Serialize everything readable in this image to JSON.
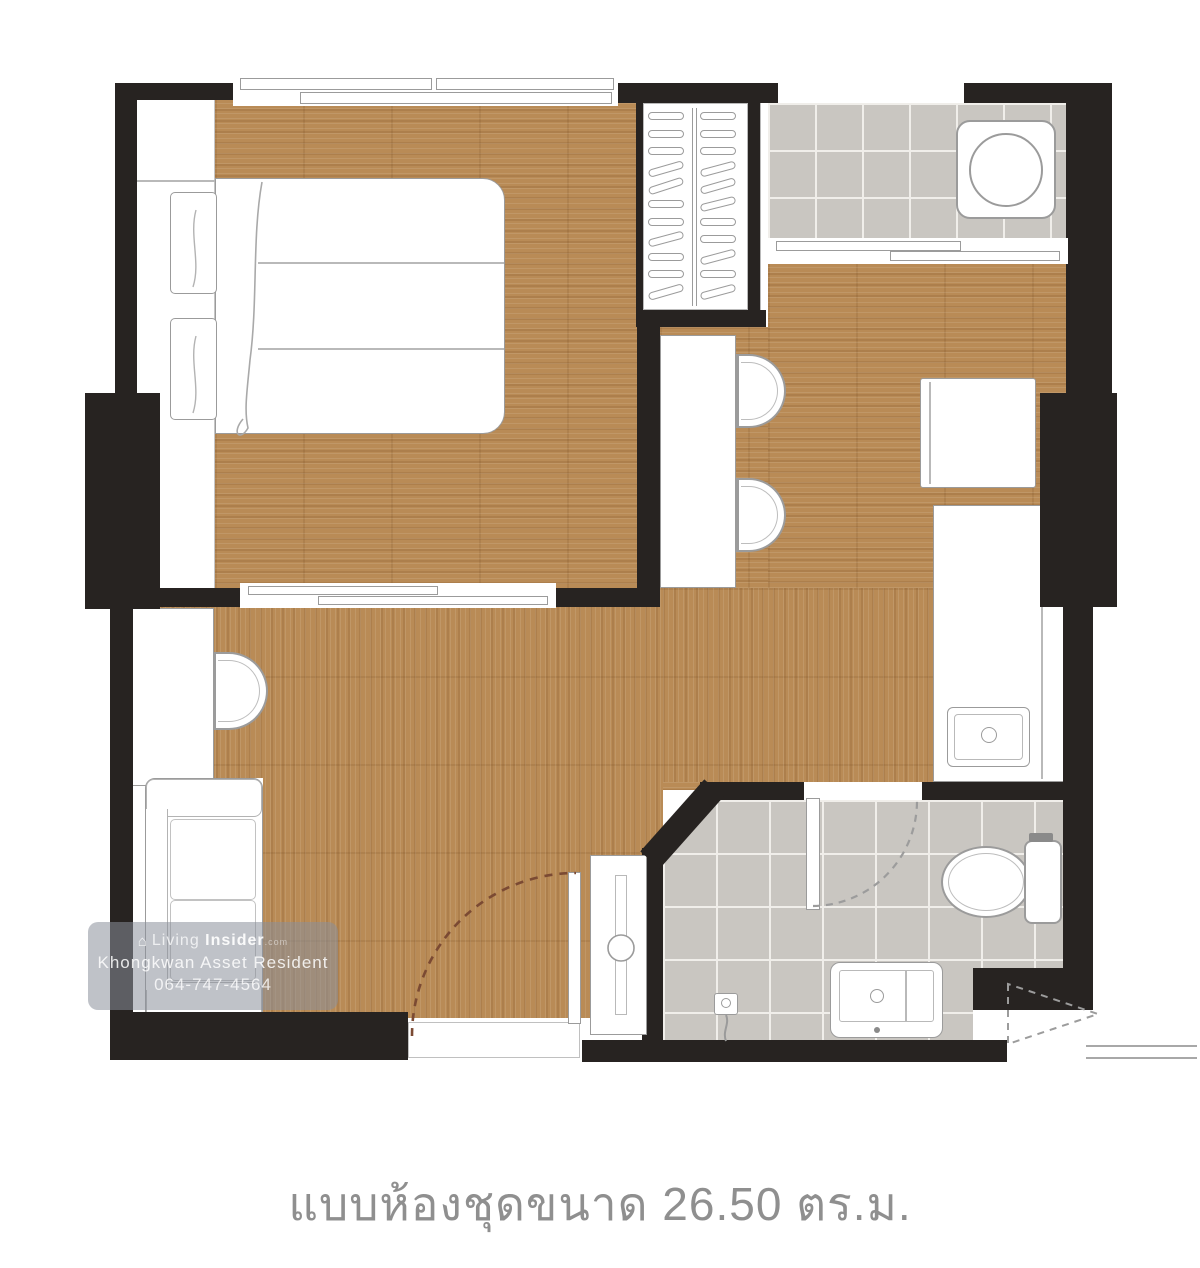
{
  "caption": {
    "text": "แบบห้องชุดขนาด 26.50 ตร.ม.",
    "area_value": "26.50",
    "area_unit": "ตร.ม."
  },
  "watermark": {
    "brand_prefix": "Living",
    "brand_suffix": "Insider",
    "brand_tld": ".com",
    "agent_name": "Khongkwan Asset Resident",
    "phone": "064-747-4564",
    "house_icon": "⌂"
  },
  "colors": {
    "wall": "#272321",
    "wood": "#b98b56",
    "tile": "#c9c6c1",
    "grout": "#f0eeea",
    "outline": "#9b9b9b",
    "inner_line": "#b9b9b9",
    "caption_text": "#8f8f8f",
    "entry_arc": "#7b4a33",
    "dash_gray": "#9c9c9c"
  }
}
